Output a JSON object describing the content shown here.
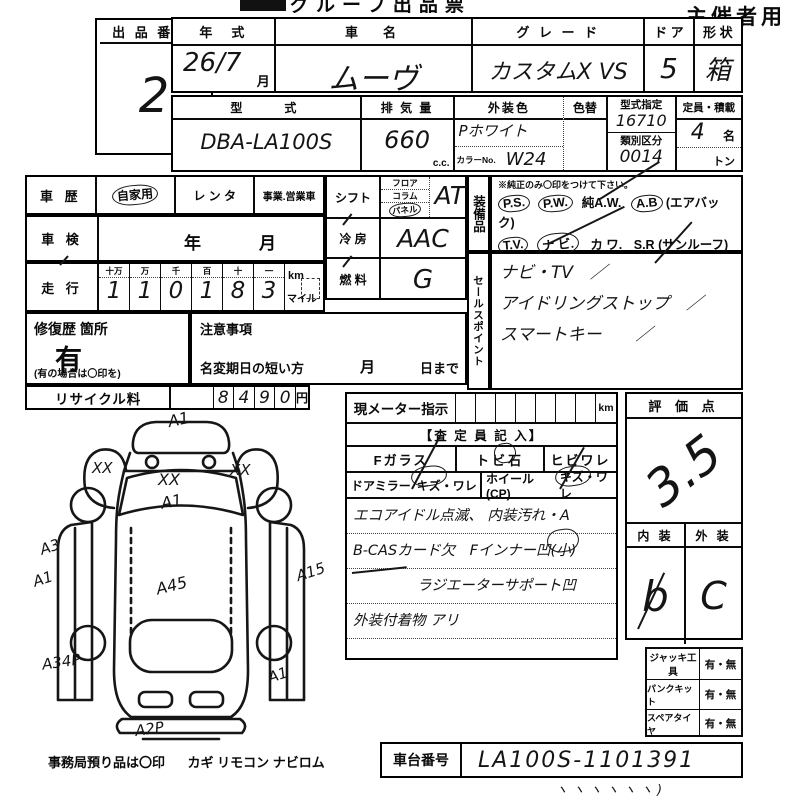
{
  "header": {
    "form_title": "グループ出品票",
    "organizer_label": "主催者用"
  },
  "lot": {
    "label": "出 品 番 号",
    "number": "2"
  },
  "top_table": {
    "year_label": "年　式",
    "year_value": "26/7",
    "year_unit": "月",
    "name_label": "車　名",
    "name_value": "ムーヴ",
    "grade_label": "グ レ ー ド",
    "grade_value": "カスタムX  VS",
    "door_label": "ド ア",
    "door_value": "5",
    "shape_label": "形 状",
    "shape_value": "箱"
  },
  "spec_table": {
    "model_label": "型　　式",
    "model_value": "DBA-LA100S",
    "disp_label": "排 気 量",
    "disp_value": "660",
    "disp_unit": "c.c.",
    "color_label": "外装色",
    "color_value": "Pホワイト",
    "color_no_label": "カラーNo.",
    "color_no_value": "W24",
    "color_change_label": "色替",
    "type_label": "型式指定",
    "type_value": "16710",
    "class_label": "類別区分",
    "class_value": "0014",
    "capacity_label": "定員・積載",
    "capacity_value": "4",
    "capacity_unit": "名",
    "ton_unit": "トン"
  },
  "history": {
    "label": "車 歴",
    "opt1": "自家用",
    "opt2": "レ ン タ",
    "opt3": "事業.営業車"
  },
  "shaken": {
    "label": "車 検",
    "year_unit": "年",
    "month_unit": "月"
  },
  "mileage": {
    "label": "走 行",
    "h1": "十万",
    "h2": "万",
    "h3": "千",
    "h4": "百",
    "h5": "十",
    "h6": "一",
    "d1": "1",
    "d2": "1",
    "d3": "0",
    "d4": "1",
    "d5": "8",
    "d6": "3",
    "unit_km": "km",
    "unit_mile": "マイル"
  },
  "repair": {
    "label": "修復歴 箇所",
    "value": "有",
    "note": "(有の場合は〇印を)"
  },
  "caution": {
    "label": "注意事項",
    "rename_label": "名変期日の短い方",
    "month_unit": "月",
    "day_unit": "日まで"
  },
  "recycle": {
    "label": "リサイクル料",
    "d1": "8",
    "d2": "4",
    "d3": "9",
    "d4": "0",
    "unit": "円"
  },
  "shift": {
    "label": "シフト",
    "opt1": "フロア",
    "opt2": "コラム",
    "opt3": "パネル",
    "value": "AT"
  },
  "aircon": {
    "label": "冷 房",
    "value": "AAC"
  },
  "fuel": {
    "label": "燃 料",
    "value": "G"
  },
  "equipment": {
    "vertical_label": "装備品",
    "note": "※純正のみ〇印をつけて下さい。",
    "r1a": "P.S.",
    "r1b": "P.W.",
    "r1c": "純A.W.",
    "r1d": "A.B",
    "r1e": "(エアバック)",
    "r2a": "T.V.",
    "r2b": "ナ ビ.",
    "r2c": "カ ワ.",
    "r2d": "S.R",
    "r2e": "(サンルーフ)",
    "r3a": "ABS",
    "r3b": "・",
    "r3c": "新車保証書",
    "r3d": "←(注) 後日送りのみ"
  },
  "sales": {
    "vertical_label": "セールスポイント",
    "line1": "ナビ・TV　／",
    "line2": "アイドリングストップ　／",
    "line3": "スマートキー　　／"
  },
  "meter": {
    "label": "現メーター指示",
    "unit": "km"
  },
  "assessor": {
    "header": "【査 定 員 記 入】",
    "fglass_label": "Fガラス",
    "fglass_opt1": "トビ石",
    "fglass_opt2": "ヒビワレ",
    "mirror_label": "ドアミラー",
    "mirror_opts": "キズ・ワレ",
    "wheel_label": "ホイール(CP)",
    "wheel_opts": "キズ・ワレ",
    "note1": "エコアイドル点滅、 内装汚れ・A",
    "note2": "B-CASカード欠　Fインナー凹(小)",
    "note3": "ラジエーターサポート凹",
    "note4": "外装付着物 アリ"
  },
  "score": {
    "label": "評 価 点",
    "value": "3.5",
    "interior_label": "内 装",
    "interior_value": "b",
    "exterior_label": "外 装",
    "exterior_value": "C"
  },
  "tools": {
    "jack_label": "ジャッキ工 具",
    "jack_value": "有・無",
    "pank_label": "パンクキット",
    "pank_value": "有・無",
    "spare_label": "スペアタイヤ",
    "spare_value": "有・無"
  },
  "chassis": {
    "label": "車台番号",
    "value": "LA100S-1101391",
    "ticks": "ヽヽヽヽヽヽ)"
  },
  "custody": {
    "label": "事務局預り品は〇印",
    "items": "カギ  リモコン  ナビロム"
  },
  "diagram": {
    "marks": {
      "front": "A1",
      "left_mirror": "XX",
      "windshield": "XX",
      "windshield2": "A1",
      "right_mirror": "XX",
      "left_a3": "A3",
      "left_a1": "A1",
      "right_a15": "A15",
      "roof": "A45",
      "left_rear": "A34P",
      "right_rear": "A1",
      "rear": "A2P"
    }
  }
}
